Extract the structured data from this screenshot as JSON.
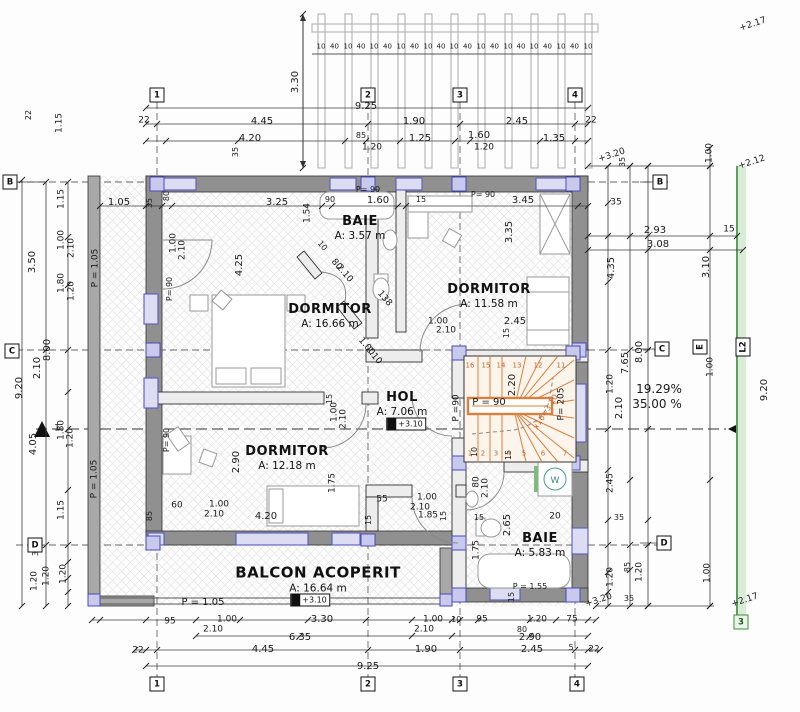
{
  "drawing": {
    "language": "ro",
    "plan_kind": "floor plan"
  },
  "rooms": [
    {
      "name": "BAIE",
      "area": "A: 3.57 m",
      "x": 360,
      "y": 228
    },
    {
      "name": "DORMITOR",
      "area": "A: 11.58 m",
      "x": 489,
      "y": 296
    },
    {
      "name": "DORMITOR",
      "area": "A: 16.66 m",
      "x": 330,
      "y": 316
    },
    {
      "name": "HOL",
      "area": "A: 7.06 m",
      "x": 402,
      "y": 404
    },
    {
      "name": "DORMITOR",
      "area": "A: 12.18 m",
      "x": 287,
      "y": 458
    },
    {
      "name": "BAIE",
      "area": "A: 5.83 m",
      "x": 540,
      "y": 545
    },
    {
      "name": "BALCON ACOPERIT",
      "area": "A: 16.64 m",
      "x": 318,
      "y": 579,
      "big": true
    }
  ],
  "grid_markers": [
    {
      "t": "1",
      "x": 157,
      "y": 95
    },
    {
      "t": "2",
      "x": 368,
      "y": 95
    },
    {
      "t": "3",
      "x": 460,
      "y": 95
    },
    {
      "t": "4",
      "x": 575,
      "y": 95
    },
    {
      "t": "1",
      "x": 157,
      "y": 684
    },
    {
      "t": "2",
      "x": 368,
      "y": 684
    },
    {
      "t": "3",
      "x": 460,
      "y": 684
    },
    {
      "t": "4",
      "x": 577,
      "y": 684
    },
    {
      "t": "B",
      "x": 10,
      "y": 182
    },
    {
      "t": "C",
      "x": 12,
      "y": 351
    },
    {
      "t": "D",
      "x": 35,
      "y": 545
    },
    {
      "t": "B",
      "x": 660,
      "y": 182
    },
    {
      "t": "C",
      "x": 662,
      "y": 349
    },
    {
      "t": "D",
      "x": 664,
      "y": 543
    },
    {
      "t": "E",
      "x": 700,
      "y": 347,
      "r": -90
    },
    {
      "t": "L2",
      "x": 743,
      "y": 347,
      "r": -90,
      "wide": true
    },
    {
      "t": "3",
      "x": 741,
      "y": 622,
      "green": true
    }
  ],
  "level_markers": [
    {
      "t": "+3.10",
      "x": 406,
      "y": 424
    },
    {
      "t": "+3.10",
      "x": 310,
      "y": 600
    }
  ],
  "pergola": {
    "label_a": "10",
    "label_b": "40",
    "dim": "3.30"
  },
  "stair": {
    "bottom_treads": [
      "1",
      "2",
      "3",
      "4",
      "5",
      "6",
      "7"
    ],
    "top_treads": [
      "16",
      "15",
      "14",
      "13",
      "12",
      "11"
    ],
    "riser_note": "x16=3.10"
  },
  "fixtures": {
    "washing_machine_label": "W"
  },
  "slope_notes": [
    "19.29%",
    "35.00 %"
  ],
  "colors": {
    "stair_accent": "#d9803f",
    "window_stroke": "#5b5bbd",
    "window_fill": "#dcdcf2",
    "boundary_green": "#3d8b3d",
    "wall_gray": "#909090"
  },
  "labels": [
    {
      "t": "3.30",
      "x": 296,
      "y": 82,
      "r": -90
    },
    {
      "t": "9.25",
      "x": 366,
      "y": 107
    },
    {
      "t": "22",
      "x": 144,
      "y": 121,
      "s": 9
    },
    {
      "t": "4.45",
      "x": 262,
      "y": 122
    },
    {
      "t": "1.90",
      "x": 414,
      "y": 122
    },
    {
      "t": "2.45",
      "x": 517,
      "y": 122
    },
    {
      "t": "22",
      "x": 591,
      "y": 121,
      "s": 9
    },
    {
      "t": "4.20",
      "x": 250,
      "y": 139
    },
    {
      "t": "85",
      "x": 361,
      "y": 136,
      "s": 8
    },
    {
      "t": "1.25",
      "x": 420,
      "y": 139
    },
    {
      "t": "1.60",
      "x": 479,
      "y": 136
    },
    {
      "t": "1.35",
      "x": 554,
      "y": 139
    },
    {
      "t": "1.20",
      "x": 372,
      "y": 148,
      "s": 9
    },
    {
      "t": "1.20",
      "x": 484,
      "y": 148,
      "s": 9
    },
    {
      "t": "35",
      "x": 236,
      "y": 152,
      "r": -90,
      "s": 8
    },
    {
      "t": "+3.20",
      "x": 612,
      "y": 156,
      "r": -18,
      "s": 9
    },
    {
      "t": "35",
      "x": 623,
      "y": 162,
      "r": -90,
      "s": 8
    },
    {
      "t": "1.00",
      "x": 710,
      "y": 153,
      "r": -90,
      "s": 9
    },
    {
      "t": "+2.12",
      "x": 752,
      "y": 163,
      "r": -18,
      "s": 9
    },
    {
      "t": "+2.17",
      "x": 753,
      "y": 25,
      "r": -18,
      "s": 9
    },
    {
      "t": "22",
      "x": 29,
      "y": 115,
      "r": -90,
      "s": 8
    },
    {
      "t": "1.15",
      "x": 60,
      "y": 123,
      "r": -90,
      "s": 9
    },
    {
      "t": "1.15",
      "x": 62,
      "y": 199,
      "r": -90,
      "s": 9
    },
    {
      "t": "3.50",
      "x": 33,
      "y": 262,
      "r": -90
    },
    {
      "t": "1.00",
      "x": 62,
      "y": 240,
      "r": -90,
      "s": 9
    },
    {
      "t": "2.10",
      "x": 72,
      "y": 248,
      "r": -90,
      "s": 9
    },
    {
      "t": "1.80",
      "x": 62,
      "y": 283,
      "r": -90,
      "s": 9
    },
    {
      "t": "1.20",
      "x": 72,
      "y": 291,
      "r": -90,
      "s": 9
    },
    {
      "t": "8.00",
      "x": 48,
      "y": 350,
      "r": -90
    },
    {
      "t": "2.10",
      "x": 38,
      "y": 368,
      "r": -90
    },
    {
      "t": "9.20",
      "x": 20,
      "y": 388,
      "r": -90
    },
    {
      "t": "1.80",
      "x": 62,
      "y": 430,
      "r": -90,
      "s": 9
    },
    {
      "t": "1.20",
      "x": 71,
      "y": 438,
      "r": -90,
      "s": 9
    },
    {
      "t": "4.05",
      "x": 34,
      "y": 444,
      "r": -90
    },
    {
      "t": "1.15",
      "x": 62,
      "y": 510,
      "r": -90,
      "s": 9
    },
    {
      "t": "32",
      "x": 36,
      "y": 551,
      "r": -90,
      "s": 8
    },
    {
      "t": "1.20",
      "x": 35,
      "y": 581,
      "r": -90,
      "s": 9
    },
    {
      "t": "1.20",
      "x": 47,
      "y": 576,
      "r": -90,
      "s": 9
    },
    {
      "t": "1.20",
      "x": 64,
      "y": 574,
      "r": -90,
      "s": 9
    },
    {
      "t": "P = 1.05",
      "x": 96,
      "y": 268,
      "r": -90,
      "s": 9
    },
    {
      "t": "P = 1.05",
      "x": 95,
      "y": 479,
      "r": -90,
      "s": 9
    },
    {
      "t": "1",
      "x": 57,
      "y": 429,
      "s": 9
    },
    {
      "t": "1.05",
      "x": 119,
      "y": 203
    },
    {
      "t": "35",
      "x": 150,
      "y": 203,
      "r": -90,
      "s": 8
    },
    {
      "t": "80",
      "x": 167,
      "y": 196,
      "r": -90,
      "s": 8
    },
    {
      "t": "3.25",
      "x": 277,
      "y": 203
    },
    {
      "t": "1.54",
      "x": 308,
      "y": 213,
      "r": -90,
      "s": 9
    },
    {
      "t": "90",
      "x": 330,
      "y": 200,
      "s": 8
    },
    {
      "t": "1.60",
      "x": 378,
      "y": 201
    },
    {
      "t": "15",
      "x": 421,
      "y": 200,
      "s": 8
    },
    {
      "t": "3.45",
      "x": 523,
      "y": 201
    },
    {
      "t": "P= 90",
      "x": 368,
      "y": 190,
      "s": 8
    },
    {
      "t": "P= 90",
      "x": 483,
      "y": 195,
      "s": 8
    },
    {
      "t": "P= 90",
      "x": 170,
      "y": 289,
      "r": -90,
      "s": 8
    },
    {
      "t": "4.25",
      "x": 240,
      "y": 265,
      "r": -90
    },
    {
      "t": "1.00",
      "x": 174,
      "y": 243,
      "r": -90,
      "s": 9
    },
    {
      "t": "2.10",
      "x": 183,
      "y": 250,
      "r": -90,
      "s": 9
    },
    {
      "t": "3.35",
      "x": 510,
      "y": 232,
      "r": -90
    },
    {
      "t": "10",
      "x": 322,
      "y": 246,
      "r": 50,
      "s": 8
    },
    {
      "t": "80",
      "x": 336,
      "y": 265,
      "r": 50,
      "s": 9
    },
    {
      "t": "2.10",
      "x": 344,
      "y": 274,
      "r": 50,
      "s": 9
    },
    {
      "t": "138",
      "x": 384,
      "y": 299,
      "r": 50,
      "s": 9
    },
    {
      "t": "1.00",
      "x": 366,
      "y": 347,
      "r": 50,
      "s": 9
    },
    {
      "t": "2.10",
      "x": 373,
      "y": 356,
      "r": 50,
      "s": 9
    },
    {
      "t": "1.00",
      "x": 438,
      "y": 322,
      "s": 9
    },
    {
      "t": "2.10",
      "x": 446,
      "y": 331,
      "s": 9
    },
    {
      "t": "2.45",
      "x": 515,
      "y": 322
    },
    {
      "t": "15",
      "x": 507,
      "y": 333,
      "r": -90,
      "s": 8
    },
    {
      "t": "P = 90",
      "x": 489,
      "y": 403
    },
    {
      "t": "2.20",
      "x": 513,
      "y": 385,
      "r": -90
    },
    {
      "t": "P= 205",
      "x": 562,
      "y": 404,
      "r": -90,
      "s": 9
    },
    {
      "t": "P =90",
      "x": 457,
      "y": 408,
      "r": -90,
      "s": 9
    },
    {
      "t": "x16=3.10",
      "x": 546,
      "y": 412,
      "r": -58,
      "s": 8,
      "c": "#c06a30"
    },
    {
      "t": "10",
      "x": 475,
      "y": 452,
      "r": -90,
      "s": 8
    },
    {
      "t": "15",
      "x": 509,
      "y": 455,
      "r": -90,
      "s": 8
    },
    {
      "t": "55",
      "x": 382,
      "y": 500,
      "s": 9
    },
    {
      "t": "1.00",
      "x": 427,
      "y": 498,
      "s": 9
    },
    {
      "t": "2.10",
      "x": 420,
      "y": 508,
      "s": 9
    },
    {
      "t": "1.85",
      "x": 428,
      "y": 516,
      "s": 9
    },
    {
      "t": "15",
      "x": 444,
      "y": 516,
      "r": -90,
      "s": 8
    },
    {
      "t": "2.90",
      "x": 237,
      "y": 462,
      "r": -90
    },
    {
      "t": "60",
      "x": 177,
      "y": 506,
      "s": 9
    },
    {
      "t": "1.00",
      "x": 219,
      "y": 505,
      "s": 9
    },
    {
      "t": "2.10",
      "x": 214,
      "y": 515,
      "s": 9
    },
    {
      "t": "4.20",
      "x": 266,
      "y": 517
    },
    {
      "t": "1.75",
      "x": 333,
      "y": 483,
      "r": -90,
      "s": 9
    },
    {
      "t": "85",
      "x": 150,
      "y": 516,
      "r": -90,
      "s": 8
    },
    {
      "t": "15",
      "x": 369,
      "y": 520,
      "r": -90,
      "s": 8
    },
    {
      "t": "15",
      "x": 330,
      "y": 399,
      "r": -90,
      "s": 8
    },
    {
      "t": "1.00",
      "x": 335,
      "y": 412,
      "r": -90,
      "s": 9
    },
    {
      "t": "2.10",
      "x": 344,
      "y": 419,
      "r": -90,
      "s": 9
    },
    {
      "t": "P= 90",
      "x": 167,
      "y": 440,
      "r": -90,
      "s": 8
    },
    {
      "t": "80",
      "x": 477,
      "y": 482,
      "r": -90,
      "s": 9
    },
    {
      "t": "2.10",
      "x": 486,
      "y": 488,
      "r": -90,
      "s": 9
    },
    {
      "t": "15",
      "x": 479,
      "y": 518,
      "s": 8
    },
    {
      "t": "20",
      "x": 555,
      "y": 517,
      "s": 9
    },
    {
      "t": "2.65",
      "x": 508,
      "y": 525,
      "r": -90
    },
    {
      "t": "1.75",
      "x": 477,
      "y": 550,
      "r": -90,
      "s": 9
    },
    {
      "t": "P = 1.55",
      "x": 530,
      "y": 587,
      "s": 8
    },
    {
      "t": "15",
      "x": 512,
      "y": 597,
      "r": -90,
      "s": 8
    },
    {
      "t": "35",
      "x": 616,
      "y": 203,
      "s": 9
    },
    {
      "t": "2.93",
      "x": 655,
      "y": 231
    },
    {
      "t": "3.08",
      "x": 658,
      "y": 245
    },
    {
      "t": "15",
      "x": 729,
      "y": 230,
      "s": 9
    },
    {
      "t": "4.35",
      "x": 612,
      "y": 268,
      "r": -90
    },
    {
      "t": "3.10",
      "x": 707,
      "y": 267,
      "r": -90
    },
    {
      "t": "8.00",
      "x": 640,
      "y": 352,
      "r": -90
    },
    {
      "t": "7.65",
      "x": 626,
      "y": 363,
      "r": -90
    },
    {
      "t": "1.00",
      "x": 711,
      "y": 367,
      "r": -90,
      "s": 9
    },
    {
      "t": "1.20",
      "x": 611,
      "y": 384,
      "r": -90,
      "s": 9
    },
    {
      "t": "2.10",
      "x": 620,
      "y": 408,
      "r": -90
    },
    {
      "t": "19.29%",
      "x": 659,
      "y": 389,
      "s": 12
    },
    {
      "t": "35.00 %",
      "x": 657,
      "y": 404,
      "s": 12
    },
    {
      "t": "9.20",
      "x": 765,
      "y": 390,
      "r": -90
    },
    {
      "t": "2.45",
      "x": 611,
      "y": 483,
      "r": -90,
      "s": 9
    },
    {
      "t": "35",
      "x": 619,
      "y": 518,
      "s": 8
    },
    {
      "t": "85",
      "x": 628,
      "y": 567,
      "r": -90,
      "s": 8
    },
    {
      "t": "1.20",
      "x": 611,
      "y": 577,
      "r": -90,
      "s": 9
    },
    {
      "t": "1.20",
      "x": 640,
      "y": 572,
      "r": -90,
      "s": 9
    },
    {
      "t": "1.00",
      "x": 708,
      "y": 573,
      "r": -90,
      "s": 9
    },
    {
      "t": "35",
      "x": 629,
      "y": 599,
      "s": 8
    },
    {
      "t": "+3.20",
      "x": 599,
      "y": 601,
      "r": -18,
      "s": 9
    },
    {
      "t": "+2.17",
      "x": 745,
      "y": 601,
      "r": -18,
      "s": 9
    },
    {
      "t": "95",
      "x": 170,
      "y": 622,
      "s": 9
    },
    {
      "t": "1.00",
      "x": 227,
      "y": 620,
      "s": 9
    },
    {
      "t": "3.30",
      "x": 322,
      "y": 620
    },
    {
      "t": "1.00",
      "x": 433,
      "y": 620,
      "s": 9
    },
    {
      "t": ".10",
      "x": 455,
      "y": 620,
      "s": 8
    },
    {
      "t": "95",
      "x": 482,
      "y": 620,
      "s": 9
    },
    {
      "t": "1.20",
      "x": 537,
      "y": 620,
      "s": 9
    },
    {
      "t": "75",
      "x": 572,
      "y": 620,
      "s": 9
    },
    {
      "t": "2.10",
      "x": 213,
      "y": 630,
      "s": 9
    },
    {
      "t": "2.10",
      "x": 424,
      "y": 630,
      "s": 9
    },
    {
      "t": "80",
      "x": 522,
      "y": 630,
      "s": 8
    },
    {
      "t": "6.35",
      "x": 300,
      "y": 638
    },
    {
      "t": "2.90",
      "x": 530,
      "y": 638
    },
    {
      "t": "22",
      "x": 138,
      "y": 651,
      "s": 9
    },
    {
      "t": "4.45",
      "x": 263,
      "y": 650
    },
    {
      "t": "1.90",
      "x": 426,
      "y": 650
    },
    {
      "t": "2.45",
      "x": 532,
      "y": 650
    },
    {
      "t": "5",
      "x": 571,
      "y": 648,
      "s": 8
    },
    {
      "t": "22",
      "x": 594,
      "y": 650,
      "s": 9
    },
    {
      "t": "9.25",
      "x": 368,
      "y": 667
    },
    {
      "t": "P = 1.05",
      "x": 203,
      "y": 603,
      "s": 10
    }
  ]
}
